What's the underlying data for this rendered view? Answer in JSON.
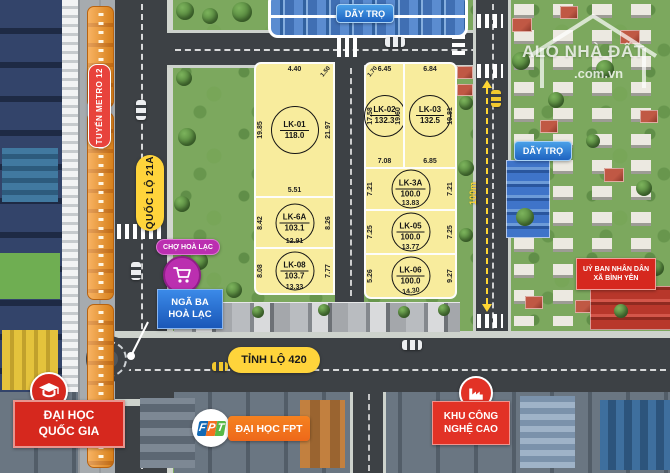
{
  "watermark": {
    "brand": "ALO NHÀ ĐẤT",
    "domain": ".com.vn"
  },
  "roads": {
    "metro": "TUYẾN METRO 12",
    "highway": "QUỐC LỘ 21A",
    "provincial": "TỈNH LỘ 420",
    "scale": "100m"
  },
  "labels": {
    "day_tro_top": "DÃY TRỌ",
    "day_tro_right": "DÃY TRỌ",
    "market": "CHỢ HOÀ LẠC",
    "junction1": "NGÃ BA",
    "junction2": "HOÀ LẠC",
    "committee1": "UỶ BAN NHÂN DÂN",
    "committee2": "XÃ BÌNH YÊN",
    "uni_nat1": "ĐẠI HỌC",
    "uni_nat2": "QUỐC GIA",
    "uni_fpt": "ĐẠI HỌC FPT",
    "hitech1": "KHU CÔNG",
    "hitech2": "NGHỆ CAO"
  },
  "fpt": {
    "f": "F",
    "p": "P",
    "t": "T"
  },
  "plots": [
    {
      "id": "LK-01",
      "area": "118.0",
      "top": "4.40",
      "corner": "1.50",
      "left": "19.85",
      "right": "21.97",
      "bottom": "5.51"
    },
    {
      "id": "LK-6A",
      "area": "103.1",
      "left": "8.42",
      "right": "8.26",
      "bottom": "12.91"
    },
    {
      "id": "LK-08",
      "area": "103.7",
      "left": "8.08",
      "right": "7.77",
      "bottom": "13.33"
    },
    {
      "id": "LK-02",
      "area": "132.3",
      "top": "6.45",
      "corner": "1.70",
      "left": "17.58",
      "right": "19.60",
      "bottom": "7.08"
    },
    {
      "id": "LK-03",
      "area": "132.5",
      "top": "6.84",
      "right": "19.81",
      "bottom": "6.85"
    },
    {
      "id": "LK-3A",
      "area": "100.0",
      "left": "7.21",
      "right": "7.21",
      "bottom": "13.83"
    },
    {
      "id": "LK-05",
      "area": "100.0",
      "left": "7.25",
      "right": "7.25",
      "bottom": "13.77"
    },
    {
      "id": "LK-06",
      "area": "100.0",
      "left": "5.26",
      "right": "9.27",
      "bottom": "14.30"
    }
  ],
  "colors": {
    "plot_fill": "#f8ec9d",
    "road": "#3d4145",
    "accent_yellow": "#ffd43b",
    "label_red": "#d6281e",
    "label_blue": "#1f63c0",
    "label_purple": "#bb2fb0",
    "metro_orange": "#f5921f"
  }
}
